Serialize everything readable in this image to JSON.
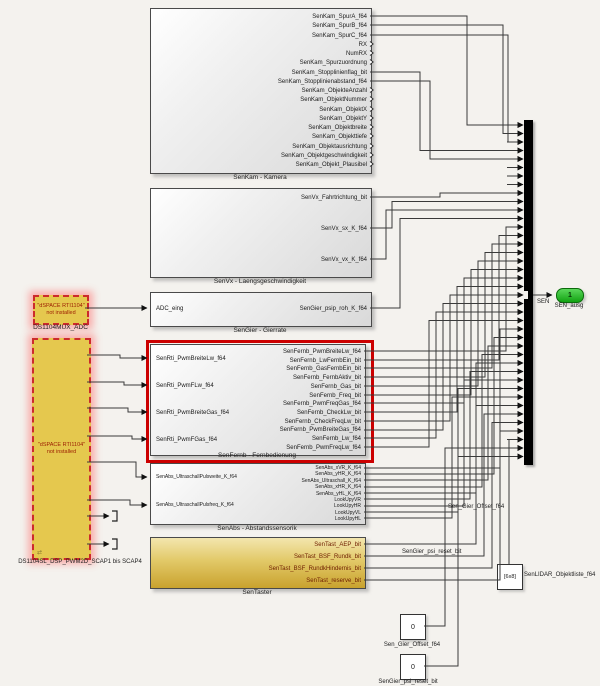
{
  "diagram": {
    "colors": {
      "highlight_red": "#cc0000",
      "dspace_yellow": "#e5c84e",
      "port_green": "#12a312",
      "mux_black": "#000000"
    },
    "blocks": {
      "senkam": {
        "label": "SenKam - Kamera",
        "outputs": [
          "SenKam_SpurA_f64",
          "SenKam_SpurB_f64",
          "SenKam_SpurC_f64",
          "RX",
          "NumRX",
          "SenKam_Spurzuordnung",
          "SenKam_Stopplinienflag_bit",
          "SenKam_Stopplinienabstand_f64",
          "SenKam_ObjekteAnzahl",
          "SenKam_ObjektNummer",
          "SenKam_ObjektX",
          "SenKam_ObjektY",
          "SenKam_Objektbreite",
          "SenKam_Objekttiefe",
          "SenKam_Objektausrichtung",
          "SenKam_Objektgeschwindigkeit",
          "SenKam_Objekt_Plausibel"
        ]
      },
      "senvx": {
        "label": "SenVx - Laengsgeschwindigkeit",
        "outputs": [
          "SenVx_Fahrtrichtung_bit",
          "SenVx_sx_K_f64",
          "SenVx_vx_K_f64"
        ]
      },
      "adcmux": {
        "title": "\"dSPACE RTI1104\"",
        "subtitle": "not installed",
        "label": "DS1104MUX_ADC"
      },
      "sengier": {
        "label": "SenGier - Gierrate",
        "input": "ADC_eing",
        "output": "SenGier_psip_roh_K_f64"
      },
      "senfernb": {
        "label": "SenFernb - Fernbedienung",
        "inputs": [
          "SenRti_PwmBreiteLw_f64",
          "SenRti_PwmFLw_f64",
          "SenRti_PwmBreiteGas_f64",
          "SenRti_PwmFGas_f64"
        ],
        "outputs": [
          "SenFernb_PwmBreiteLw_f64",
          "SenFernb_LwFernbEin_bit",
          "SenFernb_GasFernbEin_bit",
          "SenFernb_FernbAktiv_bit",
          "SenFernb_Gas_bit",
          "SenFernb_Freq_bit",
          "SenFernb_PwmFreqGas_f64",
          "SenFernb_CheckLw_bit",
          "SenFernb_CheckFreqLw_bit",
          "SenFernb_PwmBreiteGas_f64",
          "SenFernb_Lw_f64",
          "SenFernb_PwmFreqLw_f64"
        ]
      },
      "senabs": {
        "label": "SenAbs - Abstandssensorik",
        "inputs": [
          "SenAbs_UltraschallPulsweite_K_f64",
          "SenAbs_UltraschallPulsfreq_K_f64"
        ],
        "outputs": [
          "SenAbs_xVR_K_f64",
          "SenAbs_yHR_K_f64",
          "SenAbs_Ultraschall_K_f64",
          "SenAbs_xHR_K_f64",
          "SenAbs_yHL_K_f64",
          "LookUpyVR",
          "LookUpyHR",
          "LookUpyVL",
          "LookUpyHL"
        ]
      },
      "sentaster": {
        "label": "SenTaster",
        "outputs": [
          "SenTast_AEP_bit",
          "SenTast_BSF_Rundk_bit",
          "SenTast_BSF_RundkHindernis_bit",
          "SenTast_reserve_bit"
        ]
      },
      "dsp": {
        "title": "\"dSPACE RTI1104\"",
        "subtitle": "not installed",
        "label": "DS1104SL_DSP_PWM2D_SCAP1 bis SCAP4"
      }
    },
    "constants": [
      {
        "value": "[6x8]",
        "label": "SenLIDAR_Objektliste_f64"
      },
      {
        "value": "0",
        "label": "Sen_Gier_Offset_f64"
      },
      {
        "value": "0",
        "label": "SenGier_psi_reset_bit"
      }
    ],
    "outport": {
      "number": "1",
      "label": "SEN_ausg"
    },
    "wire_labels": {
      "sen": "SEN",
      "offset": "Sen_Gier_Offset_f64",
      "reset": "SenGier_psi_reset_bit"
    }
  }
}
